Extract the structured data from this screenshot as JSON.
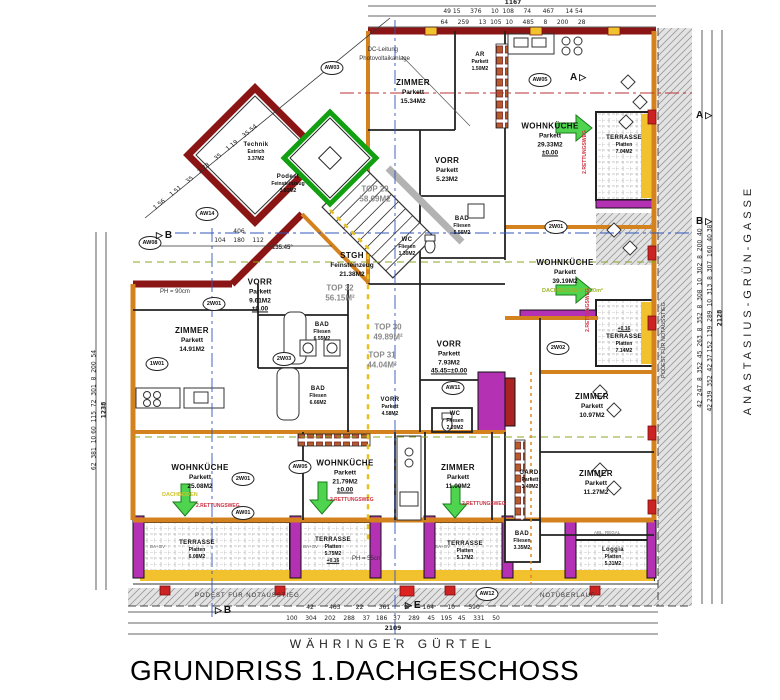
{
  "title": "GRUNDRISS 1.DACHGESCHOSS",
  "streets": {
    "bottom": "WÄHRINGER GÜRTEL",
    "right": "ANASTASIUS-GRÜN-GASSE"
  },
  "colors": {
    "wall_red": "#8b1515",
    "wall_orange": "#d4821e",
    "insulation_yellow": "#f2c12e",
    "terrace_magenta": "#b431b4",
    "elevator_green": "#12a012",
    "escape_arrow_green": "#4ed44e",
    "rescue_text_red": "#cc3344"
  },
  "rooms": {
    "zimmer_1534": {
      "name": "ZIMMER",
      "material": "Parkett",
      "area": "15.34M2"
    },
    "ar": {
      "name": "AR",
      "material": "Parkett",
      "area": "1.50M2"
    },
    "vorr_523": {
      "name": "VORR",
      "material": "Parkett",
      "area": "5.23M2"
    },
    "bad_556": {
      "name": "BAD",
      "material": "Fliesen",
      "area": "5.56M2"
    },
    "wc_130": {
      "name": "WC",
      "material": "Fliesen",
      "area": "1.30M2"
    },
    "stgh": {
      "name": "STGH",
      "material": "Feinsteinzeug",
      "area": "21.38M2"
    },
    "technik": {
      "name": "Technik",
      "material": "Estrich",
      "area": "3.37M2"
    },
    "podest": {
      "name": "Podest",
      "material": "Feinsteinzeug",
      "area": "3.81M2"
    },
    "wohnkueche_2933": {
      "name": "WOHNKÜCHE",
      "material": "Parkett",
      "area": "29.33M2",
      "note": "±0.00"
    },
    "terrasse_704": {
      "name": "TERRASSE",
      "material": "Platten",
      "area": "7.04M2"
    },
    "vorr_961": {
      "name": "VORR",
      "material": "Parkett",
      "area": "9.61M2",
      "note": "±0.00"
    },
    "zimmer_1491": {
      "name": "ZIMMER",
      "material": "Parkett",
      "area": "14.91M2"
    },
    "bad_655": {
      "name": "BAD",
      "material": "Fliesen",
      "area": "6.55M2"
    },
    "vorr_793": {
      "name": "VORR",
      "material": "Parkett",
      "area": "7.93M2",
      "note": "45.45=±0.00"
    },
    "bad_666": {
      "name": "BAD",
      "material": "Fliesen",
      "area": "6.66M2"
    },
    "vorr_458": {
      "name": "VORR",
      "material": "Parkett",
      "area": "4.58M2"
    },
    "wc_220": {
      "name": "WC",
      "material": "Fliesen",
      "area": "2.20M2"
    },
    "wohnkueche_3919": {
      "name": "WOHNKÜCHE",
      "material": "Parkett",
      "area": "39.19M2"
    },
    "terrasse_714": {
      "name": "TERRASSE",
      "material": "Platten",
      "area": "7.14M2",
      "note": "+0.16"
    },
    "zimmer_1097": {
      "name": "ZIMMER",
      "material": "Parkett",
      "area": "10.97M2"
    },
    "gard": {
      "name": "GARD.",
      "material": "Parkett",
      "area": "3.40M2"
    },
    "zimmer_1127": {
      "name": "ZIMMER",
      "material": "Parkett",
      "area": "11.27M2"
    },
    "bad_335": {
      "name": "BAD",
      "material": "Fliesen",
      "area": "3.35M2"
    },
    "zimmer_1100": {
      "name": "ZIMMER",
      "material": "Parkett",
      "area": "11.00M2"
    },
    "wohnkueche_2508": {
      "name": "WOHNKÜCHE",
      "material": "Parkett",
      "area": "25.08M2"
    },
    "wohnkueche_2179": {
      "name": "WOHNKÜCHE",
      "material": "Parkett",
      "area": "21.79M2",
      "note": "±0.00"
    },
    "terrasse_608": {
      "name": "TERRASSE",
      "material": "Platten",
      "area": "6.08M2"
    },
    "terrasse_575": {
      "name": "TERRASSE",
      "material": "Platten",
      "area": "5.75M2",
      "note": "+0.16"
    },
    "terrasse_517": {
      "name": "TERRASSE",
      "material": "Platten",
      "area": "5.17M2"
    },
    "loggia": {
      "name": "Loggia",
      "material": "Platten",
      "area": "5.31M2",
      "note": "+0.16"
    }
  },
  "tops": {
    "top29": {
      "id": "TOP 29",
      "area": "58.69M2"
    },
    "top30": {
      "id": "TOP 30",
      "area": "49.89M²"
    },
    "top31": {
      "id": "TOP 31",
      "area": "44.04M²"
    },
    "top32": {
      "id": "TOP 32",
      "area": "56.15M²"
    }
  },
  "annotations": {
    "dc1": "DC-Leitung",
    "dc2": "Photovoltaikanlage",
    "rettungsweg": "2.RETTUNGSWEG",
    "podest_notausstieg": "PODEST FÜR NOTAUSSTIEG",
    "notueberlauf": "NOTÜBERLAUF",
    "ph90": "PH = 90cm",
    "ph55": "PH = 55cm",
    "angle": "135.45°",
    "dachboden": "DACHBODEN",
    "dachboden_area": "171.20m²",
    "abl_regal": "ABL. REGAL",
    "ba_gv": "BA+GV"
  },
  "markers": {
    "a": "A",
    "b": "B",
    "e": "E"
  },
  "wall_tags": {
    "t1": "AW08",
    "t2": "AW14",
    "t3": "AW03",
    "t4": "AW05",
    "t5": "2W01",
    "t6": "2W02",
    "t7": "2W03",
    "t8": "1W01",
    "t9": "2W01",
    "t10": "AW11",
    "t11": "2W01",
    "t12": "AW01",
    "t13": "AW05",
    "t14": "AW12"
  },
  "dimensions": {
    "top_total": "1167",
    "top_row1": "49 15     376     10  108     74      467      14 54",
    "top_row2": "64     259     13  105  10     485     8     200     28",
    "bottom_row1": "42        463        22        361        8       164       10       590",
    "bottom_row2": "100    304    202    288    37   186   37    289    45   195   45    331    50",
    "bottom_total": "2109",
    "right_col1": "42  247  8  352  45  263  8  352  8  308  10  302  8  200  40",
    "right_col2": "42 239  352  42 37 152  139  289  10  313  8  307  160  40 38",
    "right_total": "2128",
    "left_col": "62  381  10 60  115  72  301  8  200  54",
    "left_total": "1238",
    "diag": "1.56    1.51    35    2.78    35    1.19    35.54",
    "b406": "406",
    "b406_sub": "104    180    112"
  }
}
